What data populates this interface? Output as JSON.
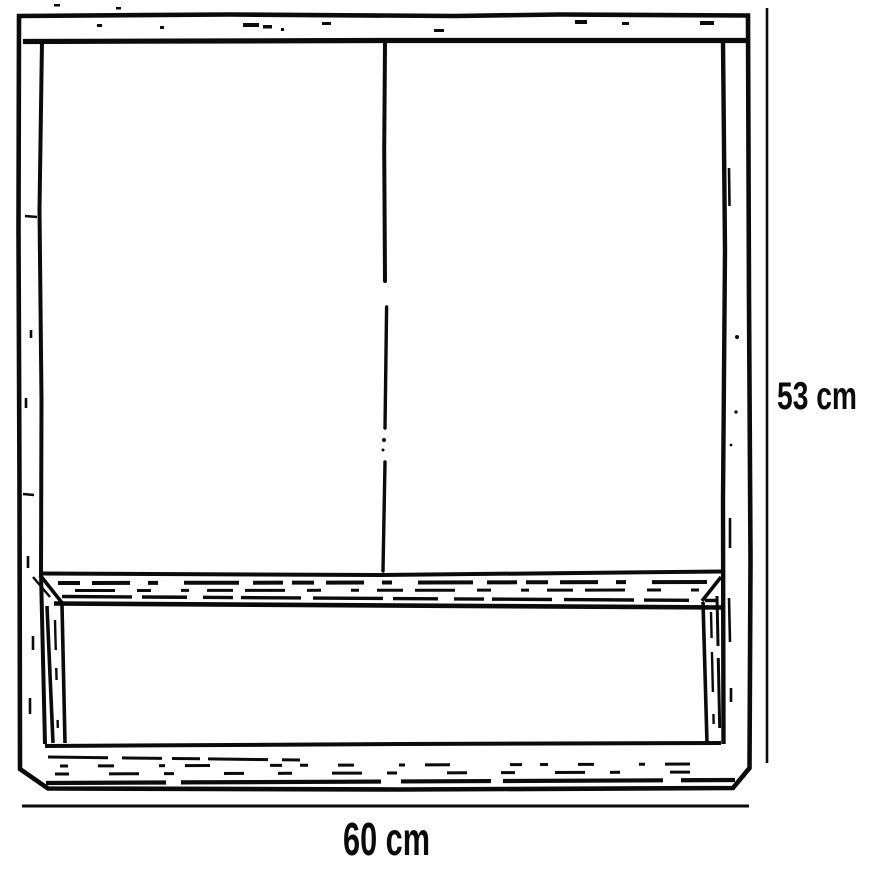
{
  "colors": {
    "ink": "#0b0b0b",
    "background": "#ffffff"
  },
  "dimensions": {
    "height": {
      "label": "53 cm"
    },
    "width": {
      "label": "60 cm"
    }
  }
}
